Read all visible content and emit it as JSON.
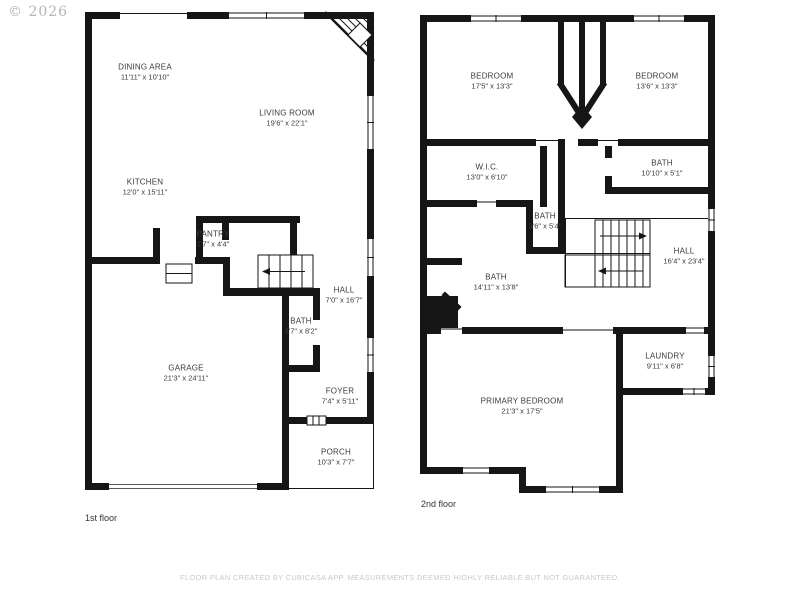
{
  "watermark": "© 2026",
  "footer": "FLOOR PLAN CREATED BY CUBICASA APP. MEASUREMENTS DEEMED HIGHLY RELIABLE BUT NOT GUARANTEED.",
  "colors": {
    "wall": "#161616",
    "label": "#3a3a3a",
    "footer_muted": "#c9c9c9",
    "watermark_gray": "#b5b5b5",
    "background": "#ffffff"
  },
  "floors": [
    {
      "name": "1st floor",
      "rooms": [
        {
          "label": "DINING AREA",
          "dims": "11'11\" x 10'10\""
        },
        {
          "label": "LIVING ROOM",
          "dims": "19'6\" x 22'1\""
        },
        {
          "label": "KITCHEN",
          "dims": "12'0\" x 15'11\""
        },
        {
          "label": "PANTRY",
          "dims": "2'7\" x 4'4\""
        },
        {
          "label": "HALL",
          "dims": "7'0\" x 16'7\""
        },
        {
          "label": "BATH",
          "dims": "3'7\" x 8'2\""
        },
        {
          "label": "GARAGE",
          "dims": "21'3\" x 24'11\""
        },
        {
          "label": "FOYER",
          "dims": "7'4\" x 5'11\""
        },
        {
          "label": "PORCH",
          "dims": "10'3\" x 7'7\""
        }
      ]
    },
    {
      "name": "2nd floor",
      "rooms": [
        {
          "label": "BEDROOM",
          "dims": "17'5\" x 13'3\""
        },
        {
          "label": "BEDROOM",
          "dims": "13'6\" x 13'3\""
        },
        {
          "label": "W.I.C.",
          "dims": "13'0\" x 6'10\""
        },
        {
          "label": "BATH",
          "dims": "10'10\" x 5'1\""
        },
        {
          "label": "BATH",
          "dims": "3'6\" x 5'4\""
        },
        {
          "label": "HALL",
          "dims": "16'4\" x 23'4\""
        },
        {
          "label": "BATH",
          "dims": "14'11\" x 13'8\""
        },
        {
          "label": "LAUNDRY",
          "dims": "9'11\" x 6'8\""
        },
        {
          "label": "PRIMARY BEDROOM",
          "dims": "21'3\" x 17'5\""
        }
      ]
    }
  ]
}
